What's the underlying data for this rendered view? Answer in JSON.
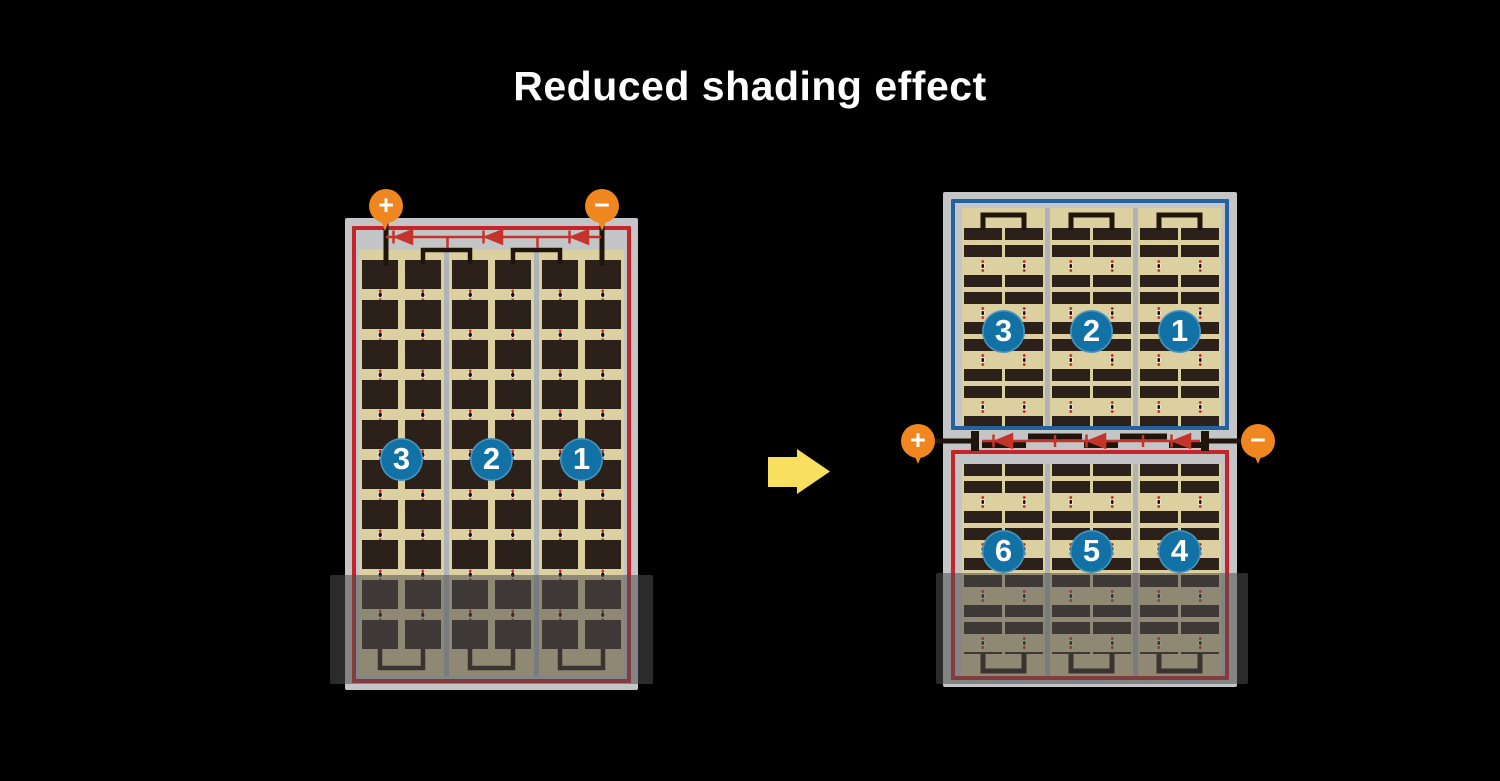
{
  "title": "Reduced shading effect",
  "colors": {
    "background": "#000000",
    "title_text": "#ffffff",
    "terminal_orange": "#f0861f",
    "section_badge_blue": "#1272a6",
    "string_border_red": "#c5242b",
    "string_border_blue": "#23629e",
    "diode_red": "#c5342c",
    "cell_tan": "#ddd0a0",
    "cell_dark": "#2b211a",
    "frame_gray": "#c4c5c7",
    "arrow_yellow": "#f8df5f"
  },
  "left_panel": {
    "terminals": [
      {
        "symbol": "+"
      },
      {
        "symbol": "−"
      }
    ],
    "sections": [
      {
        "label": "3"
      },
      {
        "label": "2"
      },
      {
        "label": "1"
      }
    ]
  },
  "right_panel": {
    "terminals": [
      {
        "symbol": "+"
      },
      {
        "symbol": "−"
      }
    ],
    "top_half": {
      "sections": [
        {
          "label": "3"
        },
        {
          "label": "2"
        },
        {
          "label": "1"
        }
      ]
    },
    "bottom_half": {
      "sections": [
        {
          "label": "6"
        },
        {
          "label": "5"
        },
        {
          "label": "4"
        }
      ]
    }
  }
}
